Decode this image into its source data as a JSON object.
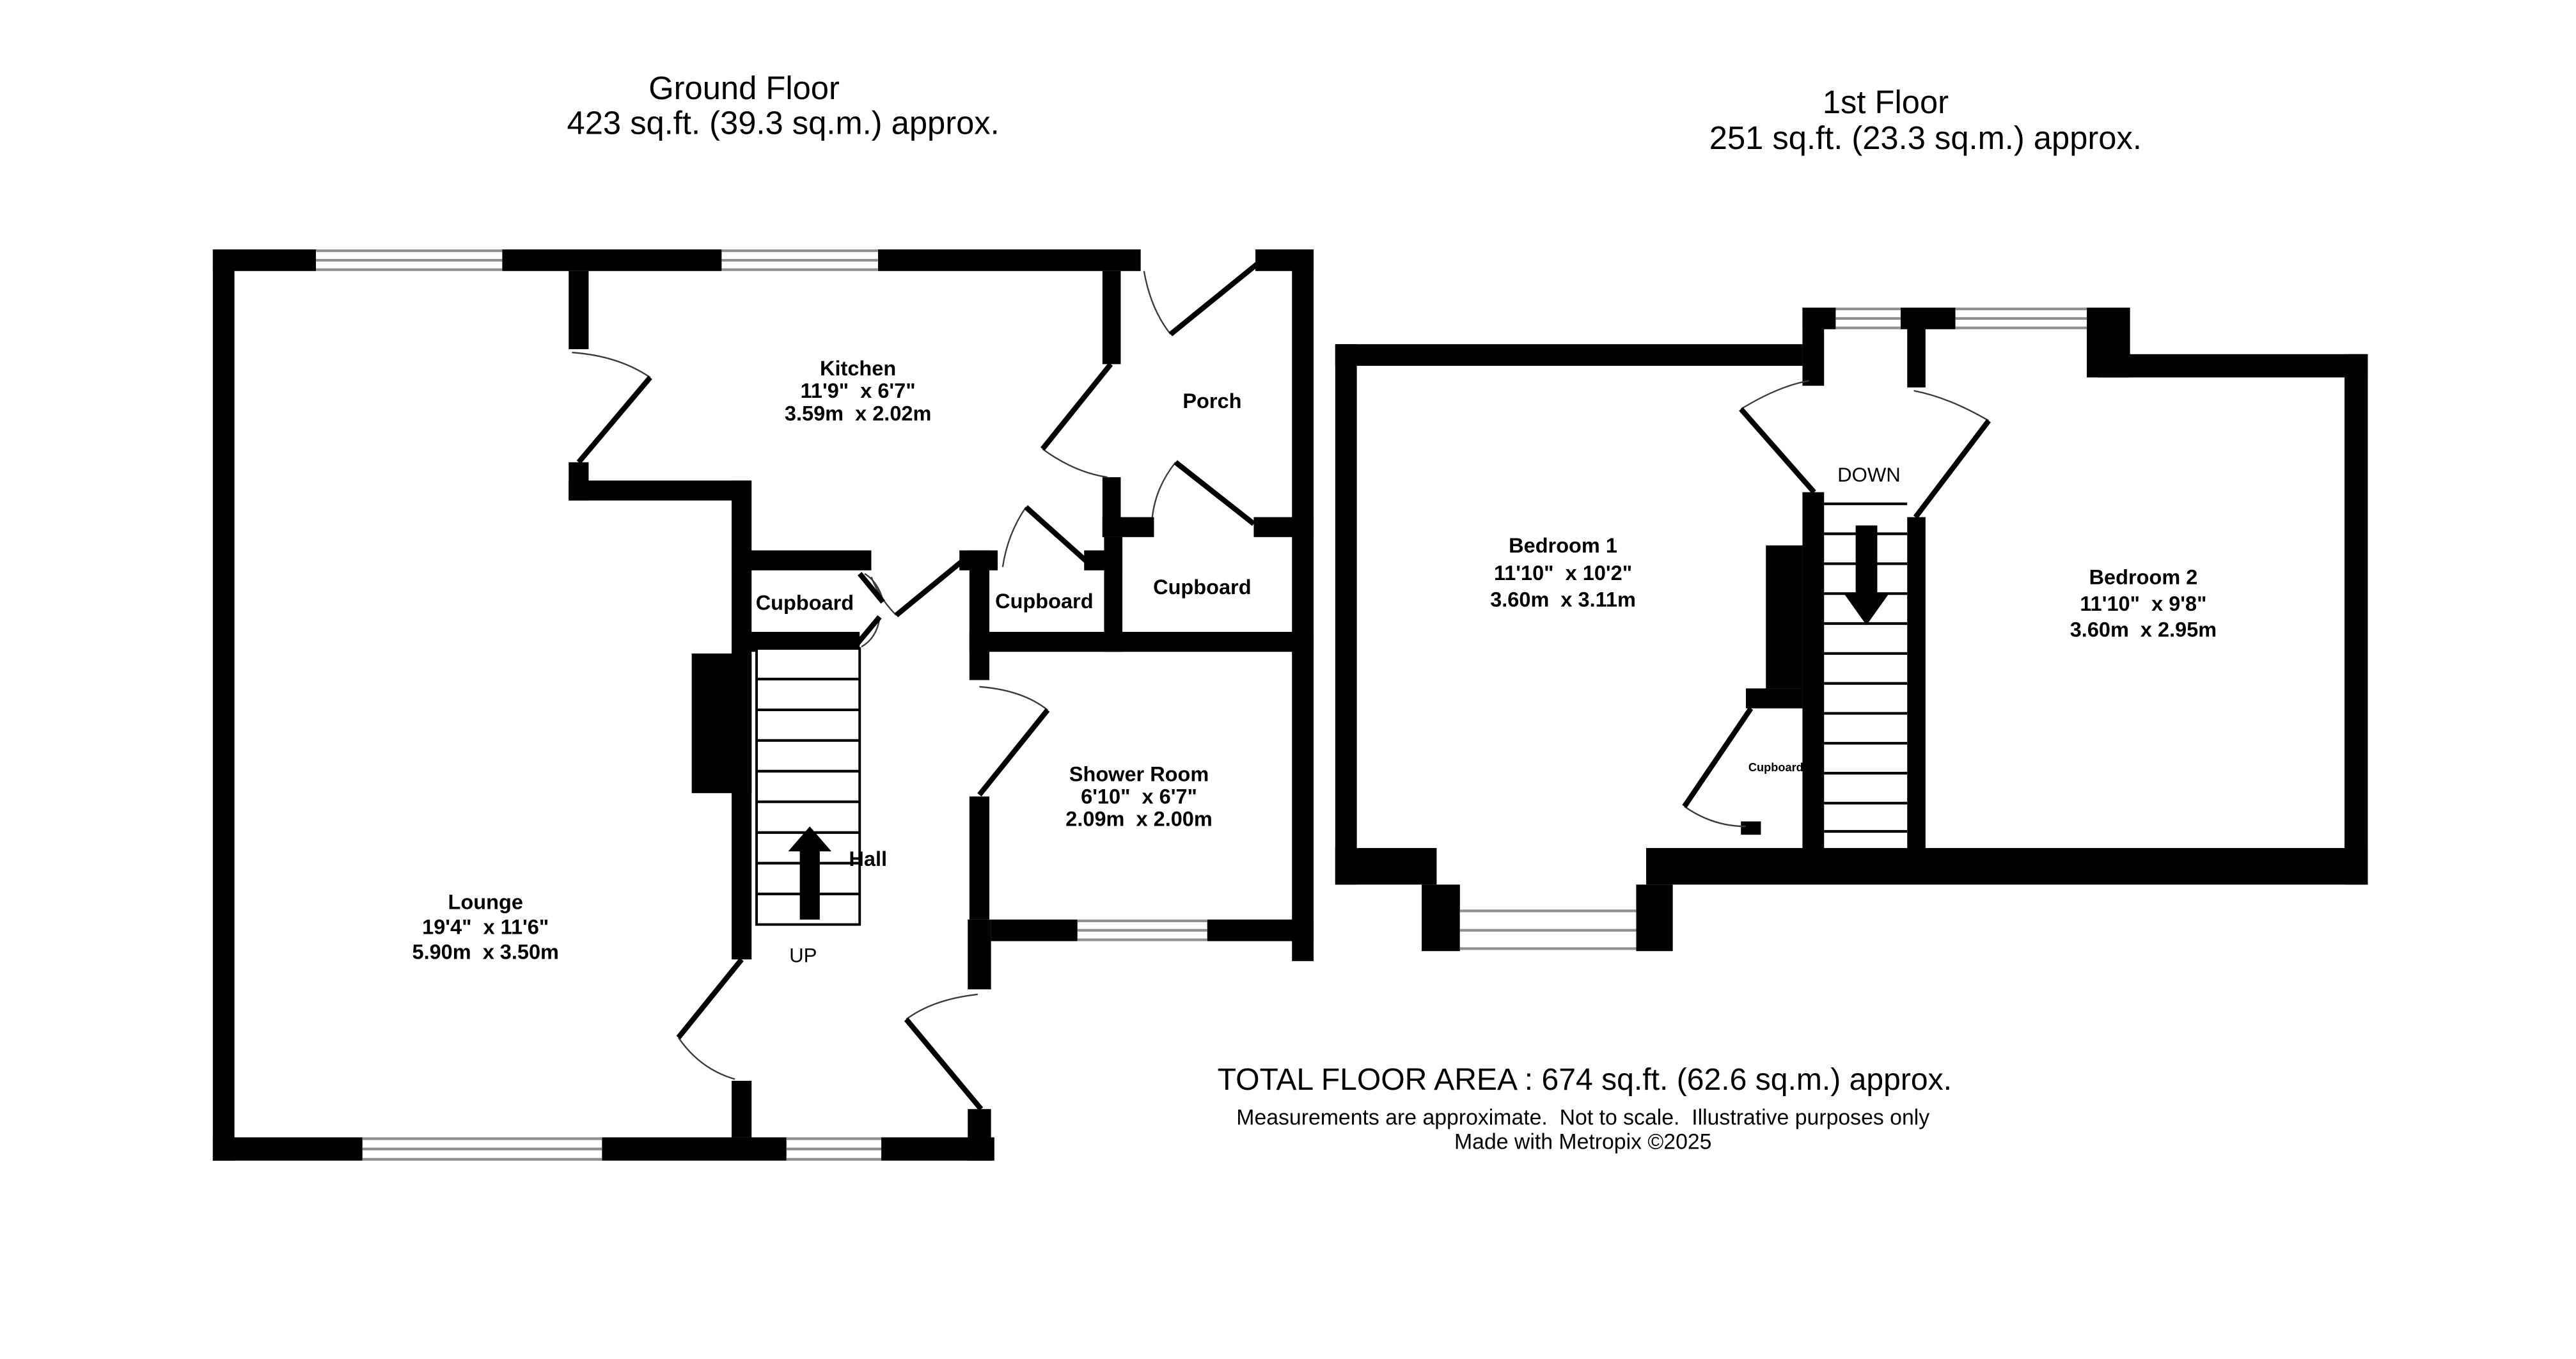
{
  "ground_floor": {
    "title": "Ground Floor",
    "area": "423 sq.ft. (39.3 sq.m.) approx.",
    "kitchen": {
      "name": "Kitchen",
      "imperial": "11'9\"  x 6'7\"",
      "metric": "3.59m  x 2.02m"
    },
    "lounge": {
      "name": "Lounge",
      "imperial": "19'4\"  x 11'6\"",
      "metric": "5.90m  x 3.50m"
    },
    "shower_room": {
      "name": "Shower Room",
      "imperial": "6'10\"  x 6'7\"",
      "metric": "2.09m  x 2.00m"
    },
    "porch": {
      "name": "Porch"
    },
    "hall": {
      "name": "Hall"
    },
    "cupboard_left": {
      "name": "Cupboard"
    },
    "cupboard_middle": {
      "name": "Cupboard"
    },
    "cupboard_right": {
      "name": "Cupboard"
    },
    "stairs_direction": "UP"
  },
  "first_floor": {
    "title": "1st Floor",
    "area": "251 sq.ft. (23.3 sq.m.) approx.",
    "bedroom1": {
      "name": "Bedroom 1",
      "imperial": "11'10\"  x 10'2\"",
      "metric": "3.60m  x 3.11m"
    },
    "bedroom2": {
      "name": "Bedroom 2",
      "imperial": "11'10\"  x 9'8\"",
      "metric": "3.60m  x 2.95m"
    },
    "cupboard": {
      "name": "Cupboard"
    },
    "stairs_direction": "DOWN"
  },
  "footer": {
    "total_area": "TOTAL FLOOR AREA : 674 sq.ft. (62.6 sq.m.) approx.",
    "disclaimer": "Measurements are approximate.  Not to scale.  Illustrative purposes only",
    "credit": "Made with Metropix ©2025"
  },
  "colors": {
    "wall": "#000000",
    "background": "#ffffff",
    "window_line": "#8f8f8f",
    "door_arc": "#3a3a3a"
  }
}
